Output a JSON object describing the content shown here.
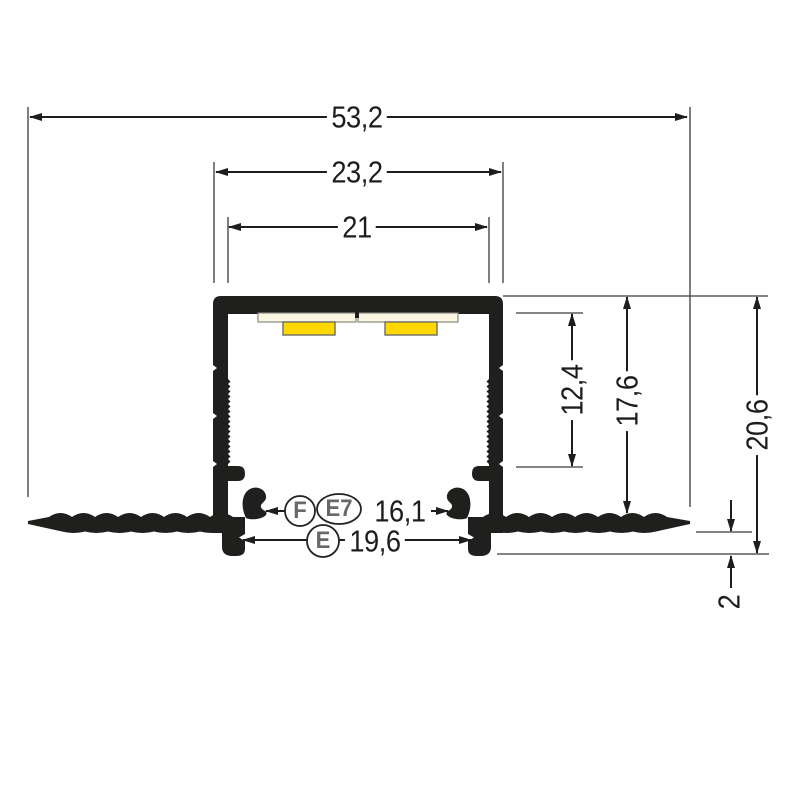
{
  "drawing": {
    "dims": {
      "overall_width": "53,2",
      "body_outer_width": "23,2",
      "body_inner_width": "21",
      "inner_depth": "12,4",
      "body_height": "17,6",
      "overall_height": "20,6",
      "flange_edge_offset": "2",
      "clip_opening": "16,1",
      "hook_opening": "19,6"
    },
    "markers": {
      "f": "F",
      "e7": "E7",
      "e": "E"
    },
    "colors": {
      "profile_black": "#1f1f1d",
      "pcb_cream": "#faf6e0",
      "led_yellow": "#ffd800",
      "line_dark": "#1d1d1b",
      "marker_gray": "#686868"
    }
  }
}
